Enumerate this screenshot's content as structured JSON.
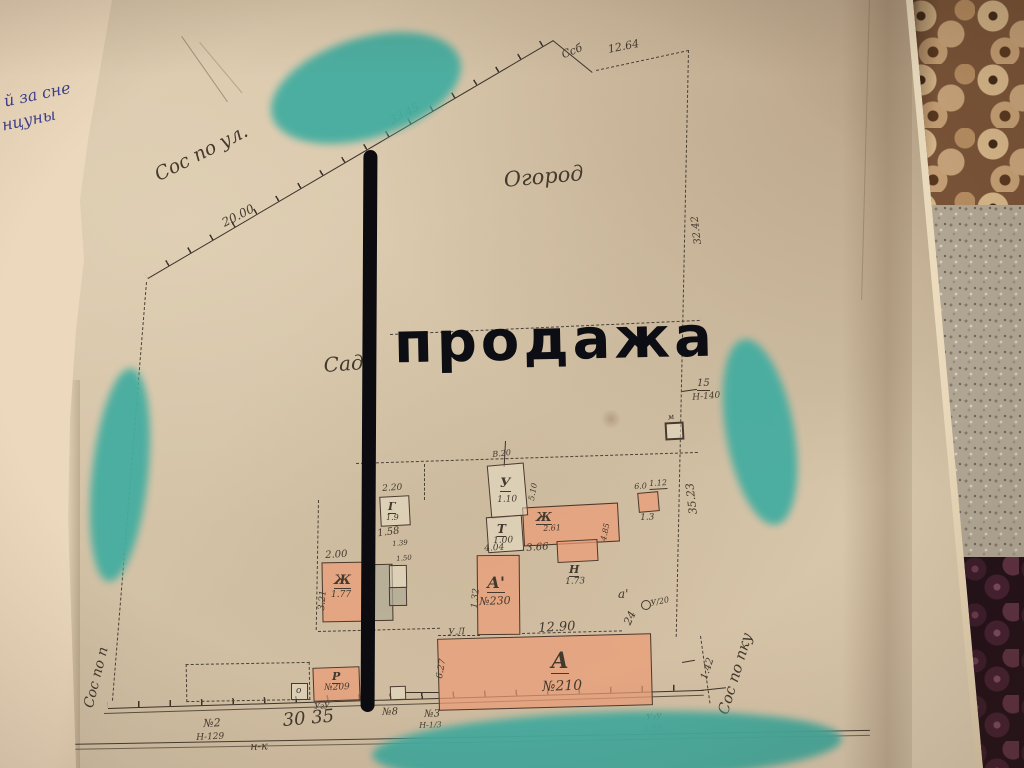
{
  "photo": {
    "subject": "hand-drawn land plot plan (old survey sheet) photographed on a carpet",
    "background_textures": [
      "hazelnuts",
      "speckled-carpet",
      "dark-berries"
    ],
    "paper_color": "#d8c5a9",
    "ink_color": "#43392e",
    "highlight_color": "#45ada0",
    "marker_color": "#0b0b10",
    "building_fill": "#ec9c76"
  },
  "side_sheet": {
    "line1": "й за сне",
    "line2": "нцуны"
  },
  "annotations": {
    "sale_text": "продажа"
  },
  "map": {
    "labels": [
      "Сос по ул.",
      "20.00",
      "33.45",
      "Ссб",
      "12.64",
      "Огород",
      "Сад",
      "32.42",
      "15",
      "Н-140",
      "35.23",
      "Сос по пку",
      "Сос по п",
      "№2",
      "Н-129",
      "30 35",
      "н-к",
      "УгУ",
      "Р",
      "№209",
      "№8",
      "№3",
      "Н-1/3",
      "6.27",
      "А",
      "№210",
      "12.90",
      "а'",
      "24",
      "У/20",
      "1.42",
      "УгУ",
      "2.55",
      "А'",
      "№230",
      "4.04",
      "1.32",
      "У.Л",
      "У",
      "1.10",
      "Т",
      "1.00",
      "В.20",
      "5.10",
      "Ж",
      "2.61",
      "4.85",
      "Н",
      "1.73",
      "3.66",
      "6.0",
      "1.12",
      "1.3",
      "м",
      "Г",
      "1.9",
      "2.20",
      "К 1.58",
      "2.00",
      "3.21",
      "Ж",
      "1.77",
      "о",
      "1.39",
      "1.50"
    ]
  }
}
